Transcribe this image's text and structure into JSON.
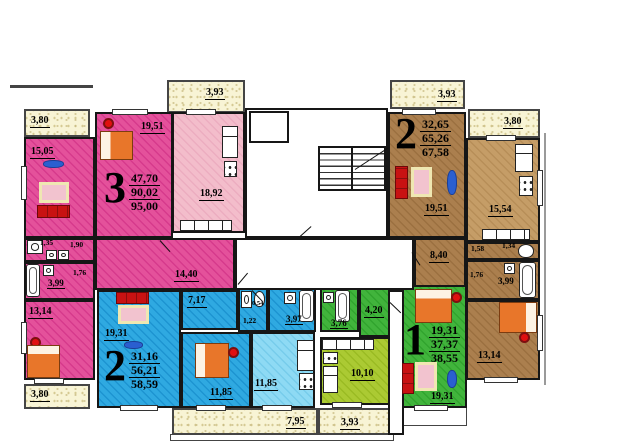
{
  "apartments": [
    {
      "number": "3",
      "a1": "47,70",
      "a2": "90,02",
      "a3": "95,00"
    },
    {
      "number": "2",
      "a1": "32,65",
      "a2": "65,26",
      "a3": "67,58"
    },
    {
      "number": "2",
      "a1": "31,16",
      "a2": "56,21",
      "a3": "58,59"
    },
    {
      "number": "1",
      "a1": "19,31",
      "a2": "37,37",
      "a3": "38,55"
    }
  ],
  "labels": {
    "balcony_top_mid": "3,93",
    "balcony_top_right": "3,93",
    "balcony_right": "3,80",
    "balcony_left_top": "3,80",
    "balcony_left_bottom": "3,80",
    "balcony_bottom": "7,95",
    "balcony_bottom_mid": "3,93",
    "pink_living": "19,51",
    "pink_room": "15,05",
    "pink_kitchen": "18,92",
    "pink_hall": "14,40",
    "pink_wc_1": "1,35",
    "pink_wc_2": "1,90",
    "pink_pass": "1,76",
    "pink_bath": "3,99",
    "pink_bedroom": "13,14",
    "blue_living": "19,31",
    "blue_hall": "7,17",
    "blue_wc_small": "0,54",
    "blue_wc": "1,22",
    "blue_bath": "3,97",
    "blue_bedroom": "11,85",
    "blue_kitchen": "11,85",
    "green_bath": "3,76",
    "green_hall": "4,20",
    "green_kitchen": "10,10",
    "green_living": "19,31",
    "brown_living": "19,51",
    "brown_kitchen": "15,54",
    "brown_hall": "8,40",
    "brown_pass1": "1,58",
    "brown_wc": "1,34",
    "brown_pass2": "1,76",
    "brown_bath": "3,99",
    "brown_bedroom": "13,14"
  },
  "colors": {
    "pink": "#e4519b",
    "pink_light": "#f3bdcb",
    "blue": "#2fa9e1",
    "blue_light": "#8edaf4",
    "green": "#41b43c",
    "green_light": "#abca33",
    "brown": "#ab7f4e",
    "brown_light": "#c59d67",
    "balcony": "#f8f4d5",
    "wall": "#161616",
    "bed": "#e8762a",
    "sofa": "#c81212",
    "rug": "#2a5fd0",
    "lamp": "#e01010"
  }
}
